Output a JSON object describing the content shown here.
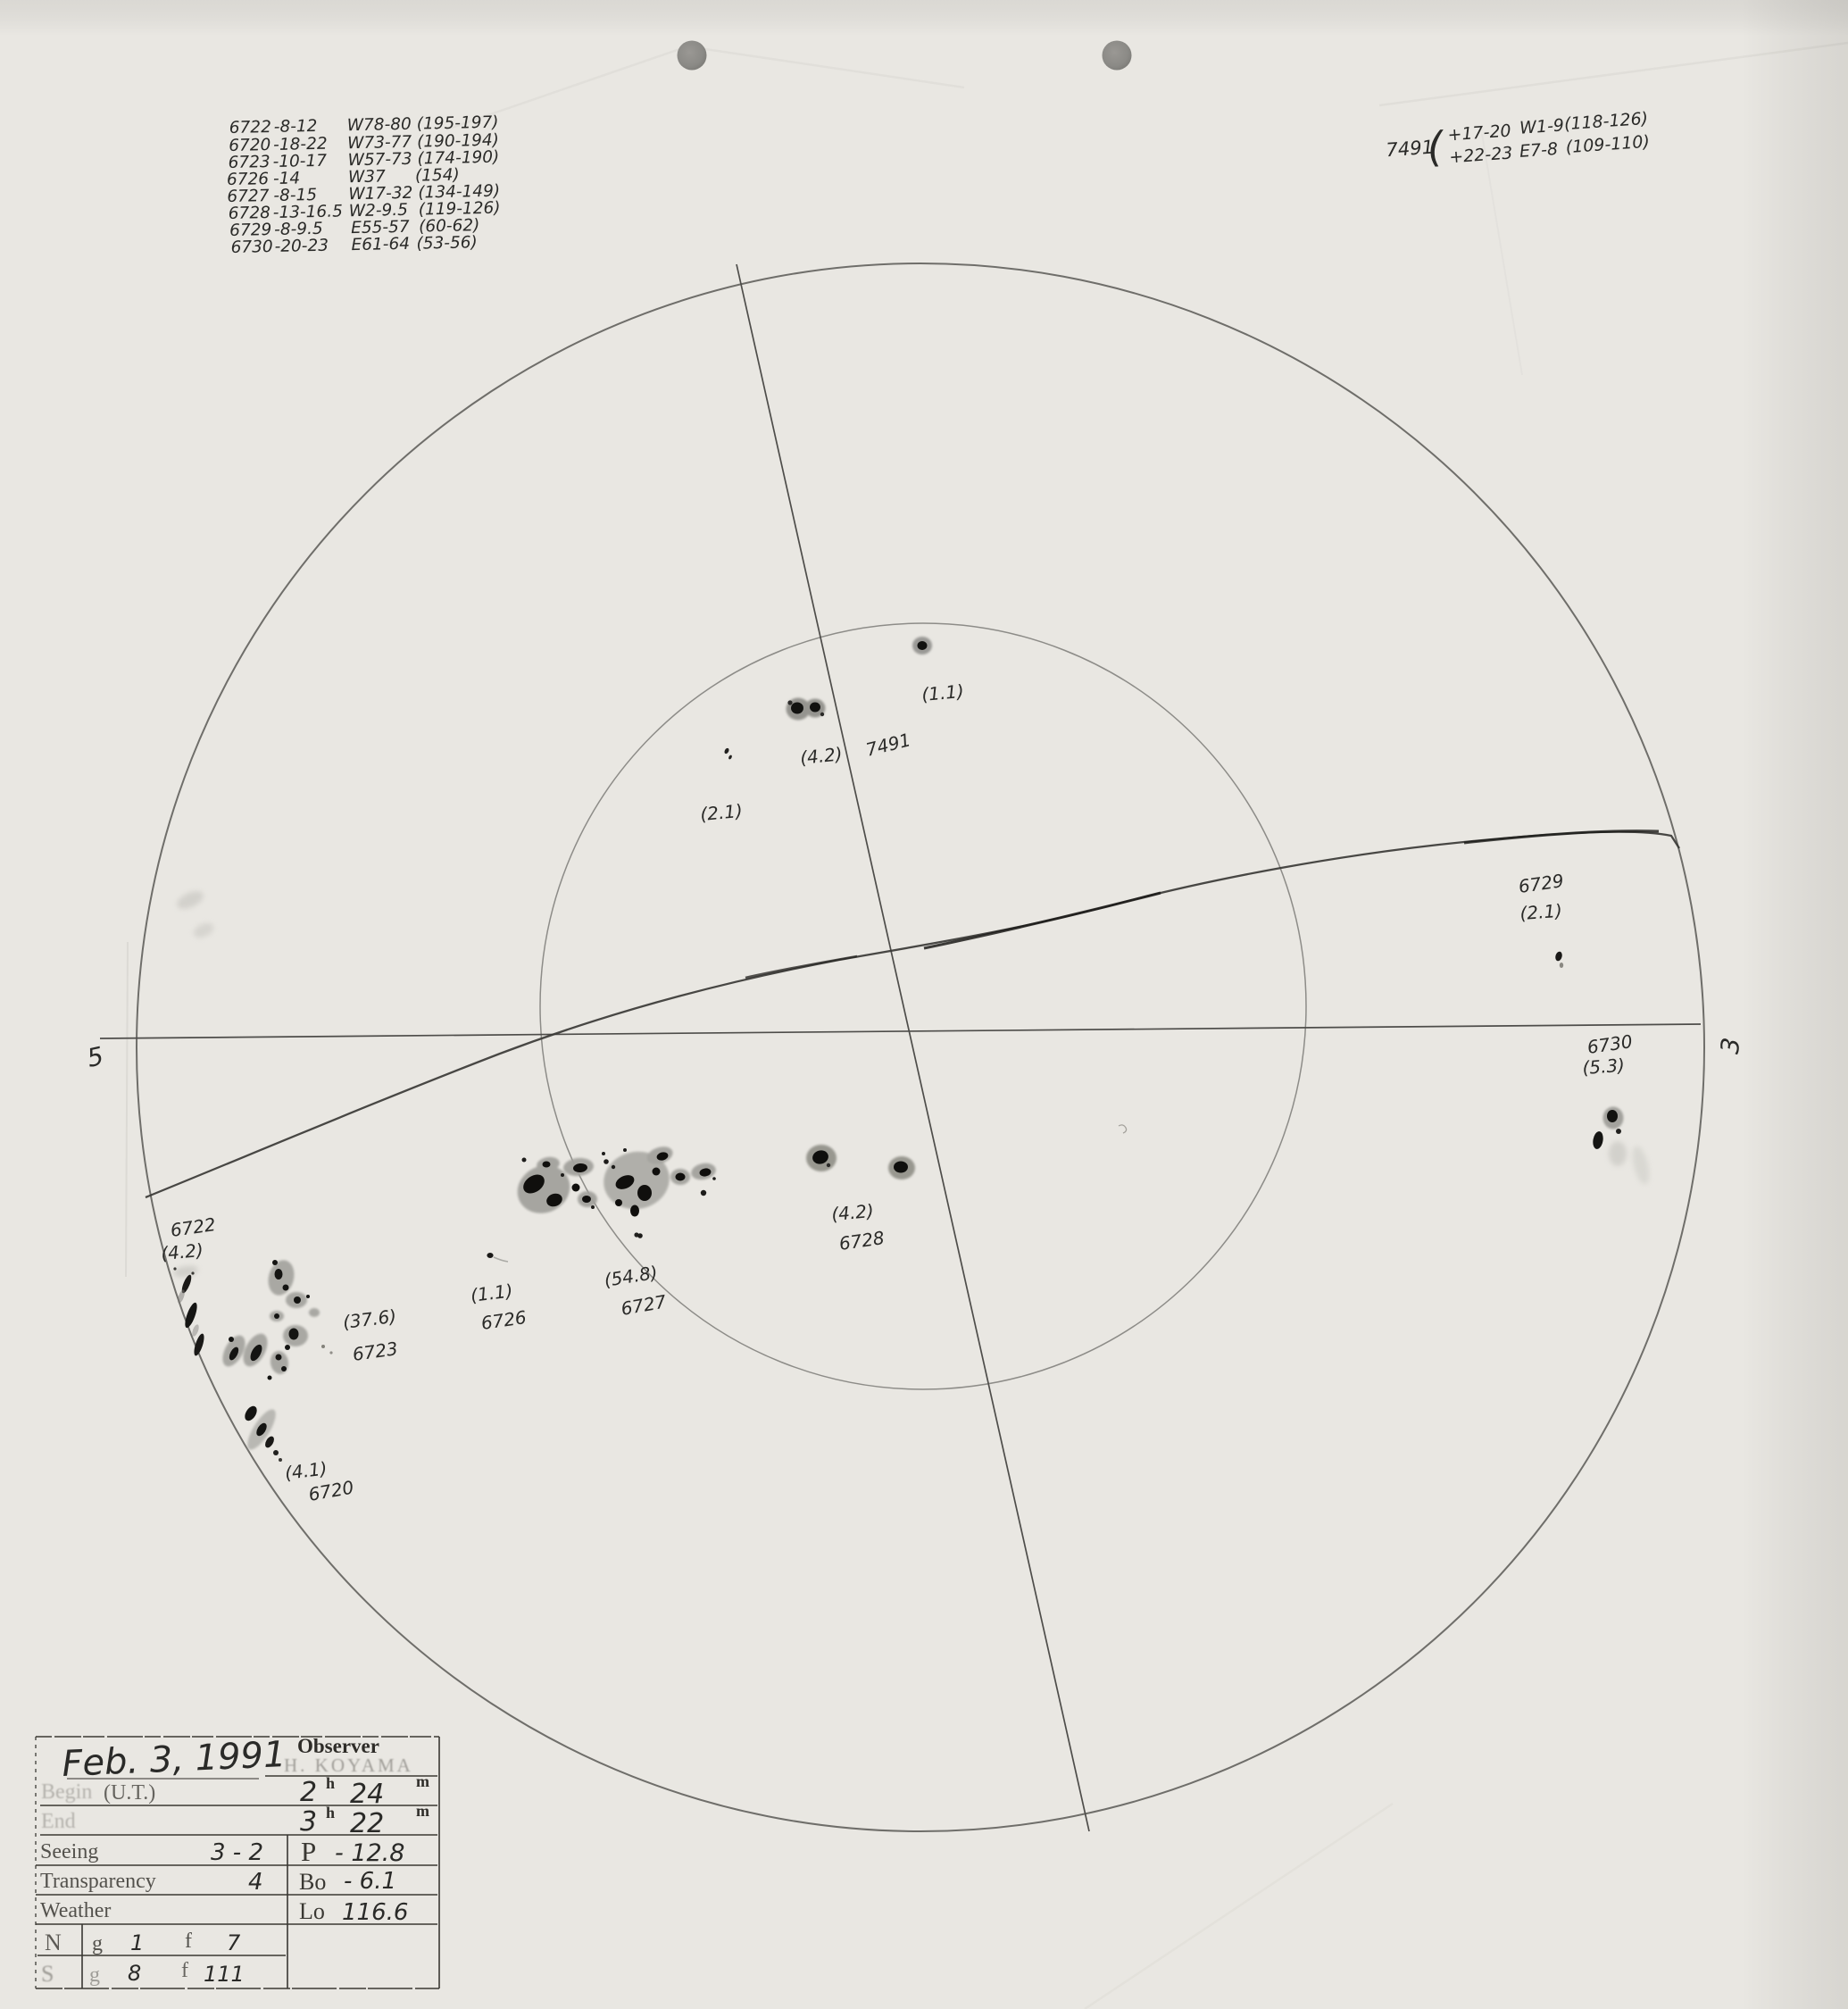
{
  "palette": {
    "paper": "#e9e7e2",
    "pencil": "#555350",
    "ink": "#2a2a28",
    "umbra": "#121210",
    "penumbra": "#a3a29d"
  },
  "annotations_top_left": {
    "rows": [
      {
        "group": "6722",
        "lat": "-8-12",
        "lon": "W78-80",
        "carr": "(195-197)"
      },
      {
        "group": "6720",
        "lat": "-18-22",
        "lon": "W73-77",
        "carr": "(190-194)"
      },
      {
        "group": "6723",
        "lat": "-10-17",
        "lon": "W57-73",
        "carr": "(174-190)"
      },
      {
        "group": "6726",
        "lat": "-14",
        "lon": "W37",
        "carr": "(154)"
      },
      {
        "group": "6727",
        "lat": "-8-15",
        "lon": "W17-32",
        "carr": "(134-149)"
      },
      {
        "group": "6728",
        "lat": "-13-16.5",
        "lon": "W2-9.5",
        "carr": "(119-126)"
      },
      {
        "group": "6729",
        "lat": "-8-9.5",
        "lon": "E55-57",
        "carr": "(60-62)"
      },
      {
        "group": "6730",
        "lat": "-20-23",
        "lon": "E61-64",
        "carr": "(53-56)"
      }
    ]
  },
  "annotation_top_right": {
    "group": "7491",
    "brace": "(",
    "line1": {
      "lat": "+17-20",
      "lon": "W1-9",
      "carr": "(118-126)"
    },
    "line2": {
      "lat": "+22-23",
      "lon": "E7-8",
      "carr": "(109-110)"
    }
  },
  "disk": {
    "west_marker": "5",
    "east_marker": "3",
    "labels": [
      {
        "id": "count-7491-north",
        "text": "(1.1)"
      },
      {
        "id": "count-7491-pair",
        "text": "(4.2)"
      },
      {
        "id": "group-7491",
        "text": "7491"
      },
      {
        "id": "count-7491-small",
        "text": "(2.1)"
      },
      {
        "id": "group-6729",
        "text": "6729"
      },
      {
        "id": "count-6729",
        "text": "(2.1)"
      },
      {
        "id": "group-6730",
        "text": "6730"
      },
      {
        "id": "count-6730",
        "text": "(5.3)"
      },
      {
        "id": "count-6728",
        "text": "(4.2)"
      },
      {
        "id": "group-6728",
        "text": "6728"
      },
      {
        "id": "count-6727",
        "text": "(54.8)"
      },
      {
        "id": "group-6727",
        "text": "6727"
      },
      {
        "id": "count-6726",
        "text": "(1.1)"
      },
      {
        "id": "group-6726",
        "text": "6726"
      },
      {
        "id": "group-6722",
        "text": "6722"
      },
      {
        "id": "count-6722",
        "text": "(4.2)"
      },
      {
        "id": "count-6723",
        "text": "(37.6)"
      },
      {
        "id": "group-6723",
        "text": "6723"
      },
      {
        "id": "count-6720",
        "text": "(4.1)"
      },
      {
        "id": "group-6720",
        "text": "6720"
      }
    ]
  },
  "table": {
    "date": "Feb. 3, 1991",
    "observer_label": "Observer",
    "observer_name": "H. KOYAMA",
    "begin_label_faint": "Begin",
    "ut_label": "(U.T.)",
    "begin_h": "2",
    "begin_m": "24",
    "end_label_faint": "End",
    "end_h": "3",
    "end_m": "22",
    "h_unit": "h",
    "m_unit": "m",
    "seeing_label": "Seeing",
    "seeing_value": "3 - 2",
    "p_label": "P",
    "p_value": "- 12.8",
    "transparency_label": "Transparency",
    "transparency_value": "4",
    "bo_label": "Bo",
    "bo_value": "- 6.1",
    "weather_label": "Weather",
    "lo_label": "Lo",
    "lo_value": "116.6",
    "north_label": "N",
    "north_g_label": "g",
    "north_g_value": "1",
    "north_f_label": "f",
    "north_f_value": "7",
    "south_label": "S",
    "south_g_label": "g",
    "south_g_value": "8",
    "south_f_label": "f",
    "south_f_value": "111"
  }
}
